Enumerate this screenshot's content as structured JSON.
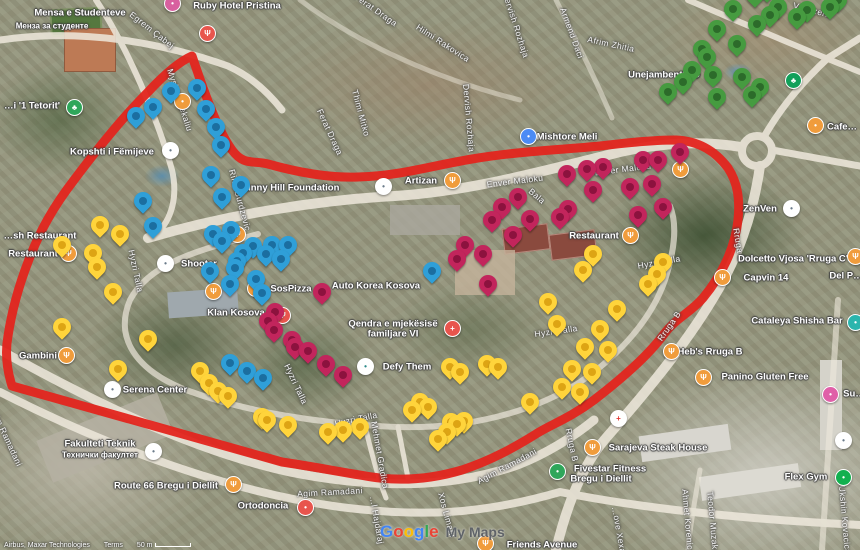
{
  "map": {
    "boundary_color": "#e3251d",
    "watermark": {
      "letters": [
        {
          "ch": "G",
          "color": "#4285F4"
        },
        {
          "ch": "o",
          "color": "#EA4335"
        },
        {
          "ch": "o",
          "color": "#FBBC05"
        },
        {
          "ch": "g",
          "color": "#4285F4"
        },
        {
          "ch": "l",
          "color": "#34A853"
        },
        {
          "ch": "e",
          "color": "#EA4335"
        }
      ],
      "suffix": "My Maps"
    },
    "attribution": {
      "imagery": "Airbus, Maxar Technologies",
      "terms": "Terms",
      "scale": "50 m"
    }
  },
  "place_labels": [
    {
      "t": "Ruby Hotel Pristina",
      "x": 237,
      "y": 6
    },
    {
      "t": "Mensa e Studenteve",
      "x": 80,
      "y": 13
    },
    {
      "t": "Менза за студенте",
      "x": 52,
      "y": 26,
      "s": 8
    },
    {
      "t": "…i '1 Tetorit'",
      "x": 32,
      "y": 106
    },
    {
      "t": "Kopshti i Fëmijeve",
      "x": 112,
      "y": 152
    },
    {
      "t": "Mishtore Meli",
      "x": 567,
      "y": 137
    },
    {
      "t": "Sunny Hill Foundation",
      "x": 289,
      "y": 188
    },
    {
      "t": "Artizan",
      "x": 421,
      "y": 181
    },
    {
      "t": "…sh Restaurant",
      "x": 40,
      "y": 236
    },
    {
      "t": "Restaurant",
      "x": 33,
      "y": 254
    },
    {
      "t": "Shooter",
      "x": 199,
      "y": 264
    },
    {
      "t": "SosPizza",
      "x": 291,
      "y": 289
    },
    {
      "t": "Auto Korea Kosova",
      "x": 376,
      "y": 286
    },
    {
      "t": "Klan Kosova",
      "x": 236,
      "y": 313
    },
    {
      "t": "Qendra e mjekësisë",
      "x": 393,
      "y": 324
    },
    {
      "t": "familjare VI",
      "x": 393,
      "y": 334
    },
    {
      "t": "Defy Them",
      "x": 407,
      "y": 367
    },
    {
      "t": "Restaurant",
      "x": 594,
      "y": 236
    },
    {
      "t": "Gambini",
      "x": 38,
      "y": 356
    },
    {
      "t": "Serena Center",
      "x": 155,
      "y": 390
    },
    {
      "t": "Fakulteti Teknik",
      "x": 100,
      "y": 444
    },
    {
      "t": "Технички факултет",
      "x": 100,
      "y": 455,
      "s": 8
    },
    {
      "t": "Route 66 Bregu i Diellit",
      "x": 166,
      "y": 486
    },
    {
      "t": "Ortodoncia",
      "x": 263,
      "y": 506
    },
    {
      "t": "Sarajeva Steak House",
      "x": 658,
      "y": 448
    },
    {
      "t": "Fivestar Fitness",
      "x": 610,
      "y": 469
    },
    {
      "t": "Bregu i Diellit",
      "x": 601,
      "y": 479
    },
    {
      "t": "Flex Gym",
      "x": 806,
      "y": 477
    },
    {
      "t": "Cataleya Shisha Bar",
      "x": 797,
      "y": 321
    },
    {
      "t": "Heb's Rruga B",
      "x": 710,
      "y": 352
    },
    {
      "t": "Panino Gluten Free",
      "x": 765,
      "y": 377
    },
    {
      "t": "Del P…",
      "x": 846,
      "y": 276
    },
    {
      "t": "Capvin 14",
      "x": 766,
      "y": 278
    },
    {
      "t": "Dolcetto Vjosa 'Rruga C'",
      "x": 793,
      "y": 259
    },
    {
      "t": "ZenVen",
      "x": 760,
      "y": 209
    },
    {
      "t": "Friends Avenue",
      "x": 542,
      "y": 545
    },
    {
      "t": "Cafe…",
      "x": 842,
      "y": 127
    },
    {
      "t": "Unejambenthito",
      "x": 664,
      "y": 75
    },
    {
      "t": "Su…",
      "x": 854,
      "y": 394
    }
  ],
  "street_labels": [
    {
      "t": "Egrem Çabej",
      "x": 152,
      "y": 30,
      "r": 38
    },
    {
      "t": "Myslym Rekaliu",
      "x": 180,
      "y": 100,
      "r": 72
    },
    {
      "t": "Ferat Draga",
      "x": 376,
      "y": 10,
      "r": 35
    },
    {
      "t": "Ferat Draga",
      "x": 330,
      "y": 132,
      "r": 65
    },
    {
      "t": "Hilmi Rakovica",
      "x": 443,
      "y": 43,
      "r": 33
    },
    {
      "t": "Thimi Mitko",
      "x": 361,
      "y": 113,
      "r": 75
    },
    {
      "t": "Dervish Rozhaja",
      "x": 516,
      "y": 25,
      "r": 72
    },
    {
      "t": "Dervish Rozhaja",
      "x": 469,
      "y": 118,
      "r": 85
    },
    {
      "t": "Armend Daci",
      "x": 572,
      "y": 33,
      "r": 70
    },
    {
      "t": "Afrim Zhitia",
      "x": 611,
      "y": 44,
      "r": 12
    },
    {
      "t": "Vellezerit",
      "x": 812,
      "y": 10,
      "r": 15
    },
    {
      "t": "Rifat Burdzevic",
      "x": 240,
      "y": 200,
      "r": 75
    },
    {
      "t": "Enver Maloku",
      "x": 515,
      "y": 181,
      "r": -7
    },
    {
      "t": "Enver Maloku",
      "x": 623,
      "y": 169,
      "r": -7
    },
    {
      "t": "Bala",
      "x": 537,
      "y": 196,
      "r": 40
    },
    {
      "t": "Hyzri Talla",
      "x": 136,
      "y": 271,
      "r": 78
    },
    {
      "t": "Hyzri Talla",
      "x": 296,
      "y": 384,
      "r": 65
    },
    {
      "t": "Hyzri Talla",
      "x": 356,
      "y": 419,
      "r": -12
    },
    {
      "t": "Hyzri Talla",
      "x": 556,
      "y": 331,
      "r": -8
    },
    {
      "t": "Hyzri Talla",
      "x": 659,
      "y": 262,
      "r": -10
    },
    {
      "t": "Rruga B",
      "x": 739,
      "y": 245,
      "r": 80
    },
    {
      "t": "Rruga B",
      "x": 669,
      "y": 326,
      "r": -55
    },
    {
      "t": "Rruga B",
      "x": 572,
      "y": 445,
      "r": 78
    },
    {
      "t": "Mehmet Gradica",
      "x": 380,
      "y": 455,
      "r": 80
    },
    {
      "t": "Agim Ramadani",
      "x": 330,
      "y": 492,
      "r": -3
    },
    {
      "t": "Agim Ramadani",
      "x": 507,
      "y": 466,
      "r": -28
    },
    {
      "t": "Agim Ramadani",
      "x": 6,
      "y": 436,
      "r": 65
    },
    {
      "t": "Xos Limani",
      "x": 447,
      "y": 515,
      "r": 75
    },
    {
      "t": "…l Hajdaraj",
      "x": 377,
      "y": 520,
      "r": 80
    },
    {
      "t": "Ahmet Korenica",
      "x": 688,
      "y": 522,
      "r": 85
    },
    {
      "t": "Teodor Muzaka",
      "x": 713,
      "y": 523,
      "r": 85
    },
    {
      "t": "Ukshin Kovacica",
      "x": 845,
      "y": 520,
      "r": 85
    },
    {
      "t": "…ove Xexa",
      "x": 619,
      "y": 530,
      "r": 80
    }
  ],
  "pois": [
    {
      "name": "lodging",
      "x": 172,
      "y": 3,
      "bg": "#d8609f",
      "glyph": "•"
    },
    {
      "name": "restaurant",
      "x": 207,
      "y": 33,
      "bg": "#e8554d",
      "glyph": "Ψ"
    },
    {
      "name": "park",
      "x": 74,
      "y": 107,
      "bg": "#2fa65a",
      "glyph": "♣"
    },
    {
      "name": "kindergarten",
      "x": 170,
      "y": 150,
      "bg": "#ffffff",
      "glyph": "•",
      "fg": "#6b7b8a"
    },
    {
      "name": "lodging",
      "x": 182,
      "y": 101,
      "bg": "#f09c3c",
      "glyph": "•"
    },
    {
      "name": "shop",
      "x": 528,
      "y": 136,
      "bg": "#4b8bf5",
      "glyph": "•"
    },
    {
      "name": "foundation",
      "x": 383,
      "y": 186,
      "bg": "#ffffff",
      "glyph": "•",
      "fg": "#6b7b8a"
    },
    {
      "name": "restaurant",
      "x": 452,
      "y": 180,
      "bg": "#f09c3c",
      "glyph": "Ψ"
    },
    {
      "name": "restaurant",
      "x": 68,
      "y": 253,
      "bg": "#f09c3c",
      "glyph": "Ψ"
    },
    {
      "name": "restaurant",
      "x": 237,
      "y": 234,
      "bg": "#f09c3c",
      "glyph": "Ψ"
    },
    {
      "name": "shop",
      "x": 165,
      "y": 263,
      "bg": "#ffffff",
      "glyph": "•",
      "fg": "#6b7b8a"
    },
    {
      "name": "restaurant",
      "x": 255,
      "y": 288,
      "bg": "#f09c3c",
      "glyph": "Ψ"
    },
    {
      "name": "restaurant",
      "x": 213,
      "y": 291,
      "bg": "#f09c3c",
      "glyph": "Ψ"
    },
    {
      "name": "restaurant",
      "x": 282,
      "y": 315,
      "bg": "#e8554d",
      "glyph": "Ψ"
    },
    {
      "name": "clinic",
      "x": 452,
      "y": 328,
      "bg": "#e8554d",
      "glyph": "+"
    },
    {
      "name": "gym",
      "x": 365,
      "y": 366,
      "bg": "#ffffff",
      "glyph": "•",
      "fg": "#2e8b8b"
    },
    {
      "name": "restaurant",
      "x": 630,
      "y": 235,
      "bg": "#f09c3c",
      "glyph": "Ψ"
    },
    {
      "name": "restaurant",
      "x": 680,
      "y": 169,
      "bg": "#f09c3c",
      "glyph": "Ψ"
    },
    {
      "name": "restaurant",
      "x": 66,
      "y": 355,
      "bg": "#f09c3c",
      "glyph": "Ψ"
    },
    {
      "name": "mall",
      "x": 112,
      "y": 389,
      "bg": "#ffffff",
      "glyph": "•",
      "fg": "#6b7b8a"
    },
    {
      "name": "university",
      "x": 153,
      "y": 451,
      "bg": "#ffffff",
      "glyph": "•",
      "fg": "#6b7b8a"
    },
    {
      "name": "restaurant",
      "x": 233,
      "y": 484,
      "bg": "#f09c3c",
      "glyph": "Ψ"
    },
    {
      "name": "dentist",
      "x": 305,
      "y": 507,
      "bg": "#e8554d",
      "glyph": "•"
    },
    {
      "name": "restaurant",
      "x": 592,
      "y": 447,
      "bg": "#f09c3c",
      "glyph": "Ψ"
    },
    {
      "name": "pharmacy",
      "x": 618,
      "y": 418,
      "bg": "#ffffff",
      "glyph": "+",
      "fg": "#e53935"
    },
    {
      "name": "gym",
      "x": 557,
      "y": 471,
      "bg": "#2fa65a",
      "glyph": "•"
    },
    {
      "name": "gym",
      "x": 843,
      "y": 477,
      "bg": "#12b04f",
      "glyph": "•"
    },
    {
      "name": "shop",
      "x": 843,
      "y": 440,
      "bg": "#ffffff",
      "glyph": "•",
      "fg": "#6b7b8a"
    },
    {
      "name": "bar",
      "x": 855,
      "y": 322,
      "bg": "#2bb5ad",
      "glyph": "•"
    },
    {
      "name": "restaurant",
      "x": 671,
      "y": 351,
      "bg": "#f09c3c",
      "glyph": "Ψ"
    },
    {
      "name": "restaurant",
      "x": 703,
      "y": 377,
      "bg": "#f09c3c",
      "glyph": "Ψ"
    },
    {
      "name": "shop",
      "x": 830,
      "y": 394,
      "bg": "#e060a8",
      "glyph": "•"
    },
    {
      "name": "restaurant",
      "x": 855,
      "y": 256,
      "bg": "#f09c3c",
      "glyph": "Ψ"
    },
    {
      "name": "restaurant",
      "x": 722,
      "y": 277,
      "bg": "#f09c3c",
      "glyph": "Ψ"
    },
    {
      "name": "shop",
      "x": 791,
      "y": 208,
      "bg": "#ffffff",
      "glyph": "•",
      "fg": "#6b7b8a"
    },
    {
      "name": "restaurant",
      "x": 485,
      "y": 543,
      "bg": "#f09c3c",
      "glyph": "Ψ"
    },
    {
      "name": "park",
      "x": 793,
      "y": 80,
      "bg": "#12a05a",
      "glyph": "♣"
    },
    {
      "name": "cafe",
      "x": 815,
      "y": 125,
      "bg": "#f09c3c",
      "glyph": "•"
    }
  ],
  "pins": [
    {
      "name": "blue",
      "points": [
        [
          136,
          129
        ],
        [
          153,
          120
        ],
        [
          171,
          104
        ],
        [
          197,
          101
        ],
        [
          206,
          122
        ],
        [
          216,
          140
        ],
        [
          221,
          158
        ],
        [
          143,
          214
        ],
        [
          153,
          239
        ],
        [
          211,
          188
        ],
        [
          222,
          210
        ],
        [
          241,
          198
        ],
        [
          213,
          247
        ],
        [
          222,
          254
        ],
        [
          231,
          243
        ],
        [
          253,
          259
        ],
        [
          266,
          267
        ],
        [
          281,
          272
        ],
        [
          243,
          266
        ],
        [
          235,
          281
        ],
        [
          256,
          292
        ],
        [
          230,
          297
        ],
        [
          262,
          306
        ],
        [
          272,
          258
        ],
        [
          288,
          258
        ],
        [
          237,
          274
        ],
        [
          432,
          284
        ],
        [
          210,
          284
        ],
        [
          230,
          376
        ],
        [
          247,
          384
        ],
        [
          263,
          391
        ]
      ]
    },
    {
      "name": "yellow",
      "points": [
        [
          100,
          238
        ],
        [
          120,
          247
        ],
        [
          62,
          258
        ],
        [
          93,
          266
        ],
        [
          97,
          280
        ],
        [
          113,
          305
        ],
        [
          62,
          340
        ],
        [
          118,
          382
        ],
        [
          148,
          352
        ],
        [
          200,
          384
        ],
        [
          209,
          396
        ],
        [
          218,
          404
        ],
        [
          228,
          409
        ],
        [
          262,
          430
        ],
        [
          267,
          433
        ],
        [
          288,
          438
        ],
        [
          328,
          445
        ],
        [
          343,
          443
        ],
        [
          360,
          440
        ],
        [
          412,
          423
        ],
        [
          420,
          415
        ],
        [
          428,
          420
        ],
        [
          438,
          452
        ],
        [
          447,
          445
        ],
        [
          451,
          435
        ],
        [
          457,
          437
        ],
        [
          464,
          434
        ],
        [
          530,
          415
        ],
        [
          450,
          380
        ],
        [
          460,
          385
        ],
        [
          487,
          377
        ],
        [
          498,
          380
        ],
        [
          548,
          315
        ],
        [
          557,
          337
        ],
        [
          593,
          267
        ],
        [
          583,
          283
        ],
        [
          663,
          275
        ],
        [
          657,
          287
        ],
        [
          648,
          297
        ],
        [
          617,
          322
        ],
        [
          600,
          342
        ],
        [
          585,
          360
        ],
        [
          608,
          363
        ],
        [
          572,
          382
        ],
        [
          592,
          385
        ],
        [
          562,
          400
        ],
        [
          580,
          405
        ]
      ]
    },
    {
      "name": "magenta",
      "points": [
        [
          567,
          187
        ],
        [
          587,
          182
        ],
        [
          603,
          180
        ],
        [
          643,
          173
        ],
        [
          658,
          173
        ],
        [
          680,
          165
        ],
        [
          593,
          203
        ],
        [
          630,
          200
        ],
        [
          652,
          197
        ],
        [
          663,
          220
        ],
        [
          568,
          222
        ],
        [
          560,
          230
        ],
        [
          530,
          232
        ],
        [
          518,
          210
        ],
        [
          502,
          220
        ],
        [
          492,
          233
        ],
        [
          513,
          248
        ],
        [
          483,
          267
        ],
        [
          465,
          258
        ],
        [
          457,
          272
        ],
        [
          488,
          297
        ],
        [
          638,
          228
        ],
        [
          322,
          305
        ],
        [
          275,
          325
        ],
        [
          268,
          334
        ],
        [
          274,
          343
        ],
        [
          292,
          353
        ],
        [
          308,
          364
        ],
        [
          326,
          377
        ],
        [
          343,
          388
        ],
        [
          295,
          360
        ]
      ]
    },
    {
      "name": "green",
      "points": [
        [
          755,
          8
        ],
        [
          767,
          3
        ],
        [
          733,
          22
        ],
        [
          778,
          20
        ],
        [
          770,
          28
        ],
        [
          757,
          37
        ],
        [
          797,
          30
        ],
        [
          807,
          23
        ],
        [
          830,
          20
        ],
        [
          838,
          13
        ],
        [
          717,
          42
        ],
        [
          737,
          57
        ],
        [
          702,
          62
        ],
        [
          707,
          70
        ],
        [
          692,
          83
        ],
        [
          713,
          88
        ],
        [
          683,
          95
        ],
        [
          668,
          105
        ],
        [
          742,
          90
        ],
        [
          760,
          100
        ],
        [
          752,
          108
        ],
        [
          717,
          110
        ]
      ]
    }
  ]
}
